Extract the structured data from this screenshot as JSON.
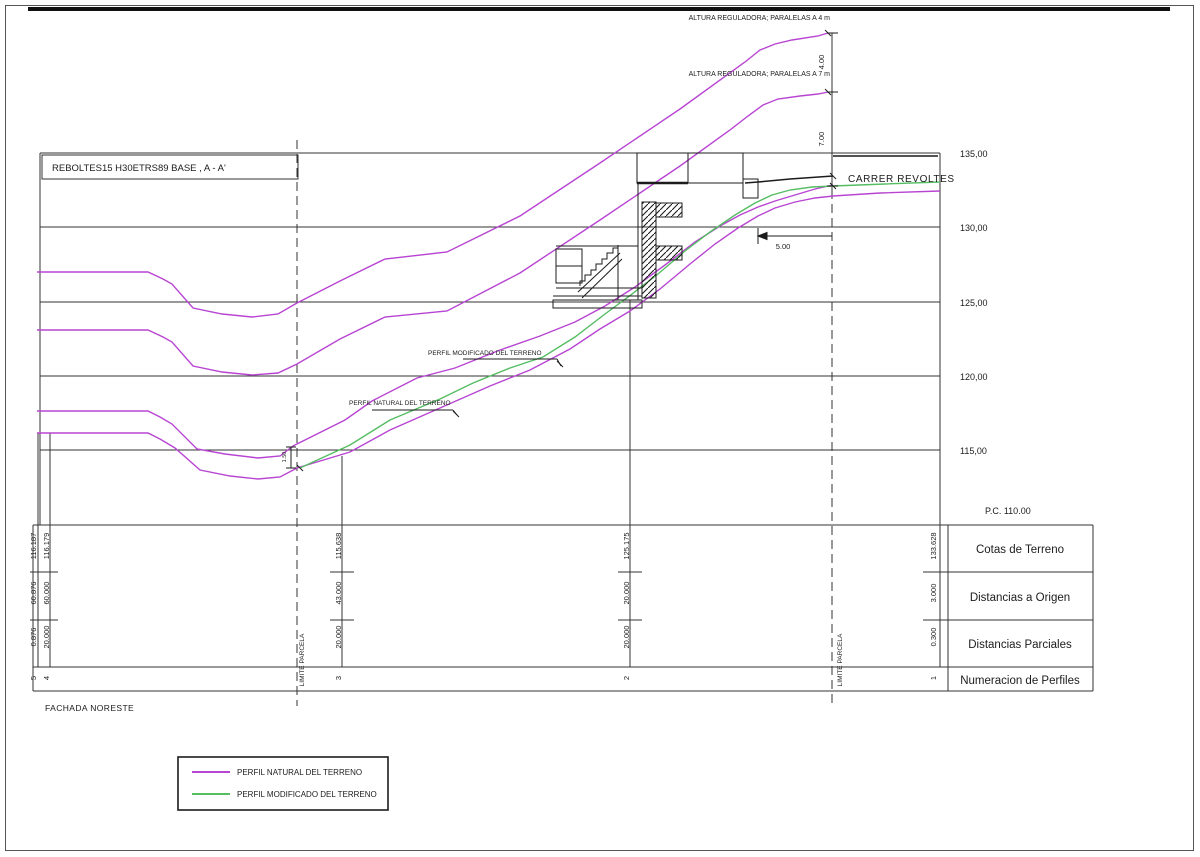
{
  "drawing": {
    "title": "REBOLTES15 H30ETRS89 BASE , A - A'",
    "facade": "FACHADA NORESTE",
    "datum": "P.C. 110.00",
    "street": "CARRER REVOLTES"
  },
  "annotations": {
    "altura_4m": "ALTURA REGULADORA; PARALELAS A 4 m",
    "altura_7m": "ALTURA REGULADORA; PARALELAS A 7 m",
    "perfil_natural": "PERFIL NATURAL DEL TERRENO",
    "perfil_modificado": "PERFIL MODIFICADO DEL TERRENO",
    "limite_parcela": "LIMITE PARCELA"
  },
  "dimensions": {
    "altura_4": "4.00",
    "altura_7": "7.00",
    "street_width": "5.00",
    "parcela_gap": "1.50"
  },
  "elevation_axis": {
    "labels": [
      "135,00",
      "130,00",
      "125,00",
      "120,00",
      "115,00"
    ]
  },
  "profile_table": {
    "row_labels": [
      "Cotas de Terreno",
      "Distancias a Origen",
      "Distancias Parciales",
      "Numeracion de Perfiles"
    ],
    "profiles": [
      {
        "num": "5",
        "cota": "116.187",
        "origen": "60.876",
        "parcial": "0.876"
      },
      {
        "num": "4",
        "cota": "116.179",
        "origen": "60.000",
        "parcial": "20.000"
      },
      {
        "num": "3",
        "cota": "115.638",
        "origen": "43.000",
        "parcial": "20.000"
      },
      {
        "num": "2",
        "cota": "125.175",
        "origen": "20.000",
        "parcial": "20.000"
      },
      {
        "num": "1",
        "cota": "133.628",
        "origen": "3.000",
        "parcial": "0.300"
      }
    ]
  },
  "legend": {
    "items": [
      {
        "label": "PERFIL NATURAL DEL TERRENO",
        "color": "#b845d2"
      },
      {
        "label": "PERFIL MODIFICADO DEL TERRENO",
        "color": "#55bd63"
      }
    ]
  },
  "colors": {
    "natural": "#b845d2",
    "modificado": "#55bd63",
    "line": "#1c1c1c"
  }
}
